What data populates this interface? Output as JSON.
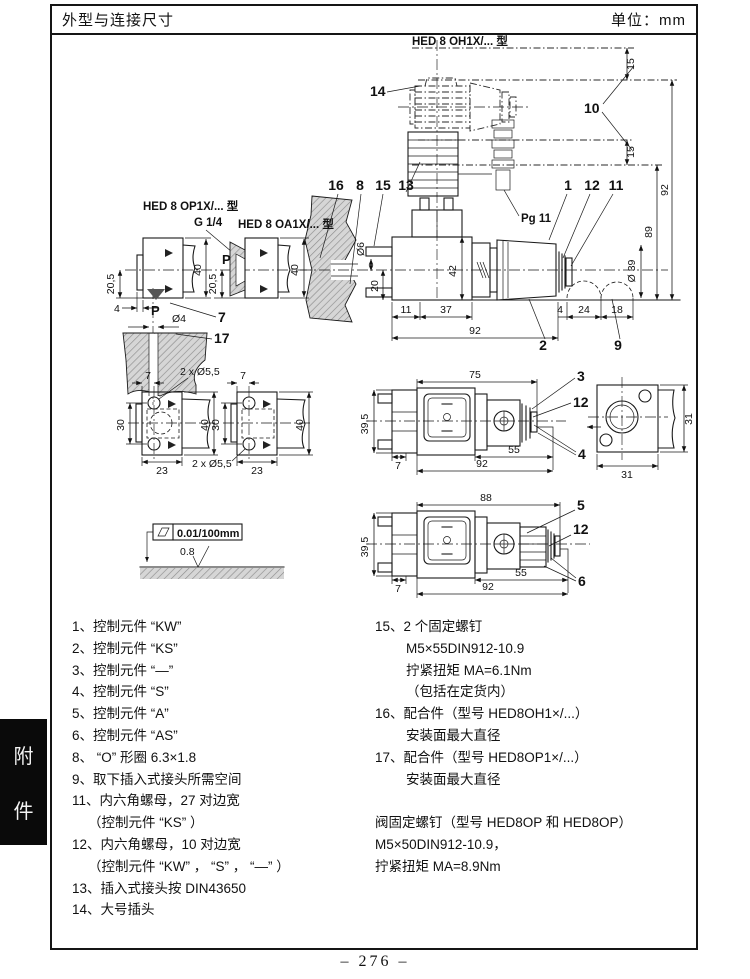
{
  "header": {
    "title": "外型与连接尺寸",
    "unit_label": "单位：mm"
  },
  "sidebar": {
    "tab_char_1": "附",
    "tab_char_2": "件"
  },
  "fig": {
    "label_oh": "HED 8 OH1X/... 型",
    "label_op": "HED 8 OP1X/... 型",
    "label_oa": "HED 8 OA1X/... 型",
    "label_g14": "G 1/4",
    "label_pg11": "Pg 11",
    "label_p": "P",
    "flatness": "0.01/100mm",
    "roughness": "0.8",
    "callouts": {
      "c1": "1",
      "c2": "2",
      "c3": "3",
      "c4": "4",
      "c5": "5",
      "c6": "6",
      "c7": "7",
      "c8": "8",
      "c9": "9",
      "c10": "10",
      "c11": "11",
      "c12": "12",
      "c13": "13",
      "c14": "14",
      "c15": "15",
      "c16": "16",
      "c17": "17"
    },
    "dims": {
      "d4": "4",
      "d7": "7",
      "d11": "11",
      "d15": "15",
      "d18": "18",
      "d20": "20",
      "d205": "20,5",
      "d23": "23",
      "d24": "24",
      "d30": "30",
      "d31": "31",
      "d37": "37",
      "d39": "Ø 39",
      "d395": "39,5",
      "d40": "40",
      "d42": "42",
      "d55": "55",
      "d2x55": "2 x Ø5,5",
      "d6": "Ø6",
      "dia4": "Ø4",
      "d75": "75",
      "d88": "88",
      "d89": "89",
      "d92": "92"
    }
  },
  "notes_left": [
    {
      "text": "1、控制元件 “KW”",
      "indent": false
    },
    {
      "text": "2、控制元件 “KS”",
      "indent": false
    },
    {
      "text": "3、控制元件 “—”",
      "indent": false
    },
    {
      "text": "4、控制元件 “S”",
      "indent": false
    },
    {
      "text": "5、控制元件 “A”",
      "indent": false
    },
    {
      "text": "6、控制元件 “AS”",
      "indent": false
    },
    {
      "text": "8、 “O” 形圈 6.3×1.8",
      "indent": false
    },
    {
      "text": "9、取下插入式接头所需空间",
      "indent": false
    },
    {
      "text": "11、内六角螺母，27 对边宽",
      "indent": false
    },
    {
      "text": "（控制元件 “KS” ）",
      "indent": true
    },
    {
      "text": "12、内六角螺母，10 对边宽",
      "indent": false
    },
    {
      "text": "（控制元件 “KW” ， “S” ， “—” ）",
      "indent": true
    },
    {
      "text": "13、插入式接头按 DIN43650",
      "indent": false
    },
    {
      "text": "14、大号插头",
      "indent": false
    }
  ],
  "notes_right": [
    {
      "text": "15、2 个固定螺钉",
      "indent": false
    },
    {
      "text": "M5×55DIN912-10.9",
      "indent": true
    },
    {
      "text": "拧紧扭矩 MA=6.1Nm",
      "indent": true
    },
    {
      "text": "（包括在定货内）",
      "indent": true
    },
    {
      "text": "16、配合件（型号 HED8OH1×/...）",
      "indent": false
    },
    {
      "text": "安装面最大直径",
      "indent": true
    },
    {
      "text": "17、配合件（型号 HED8OP1×/...）",
      "indent": false
    },
    {
      "text": "安装面最大直径",
      "indent": true
    },
    {
      "text": "",
      "indent": false
    },
    {
      "text": "阀固定螺钉（型号 HED8OP 和 HED8OP）",
      "indent": false
    },
    {
      "text": "M5×50DIN912-10.9，",
      "indent": false
    },
    {
      "text": "拧紧扭矩 MA=8.9Nm",
      "indent": false
    }
  ],
  "footer": {
    "page_number": "– 276 –"
  }
}
